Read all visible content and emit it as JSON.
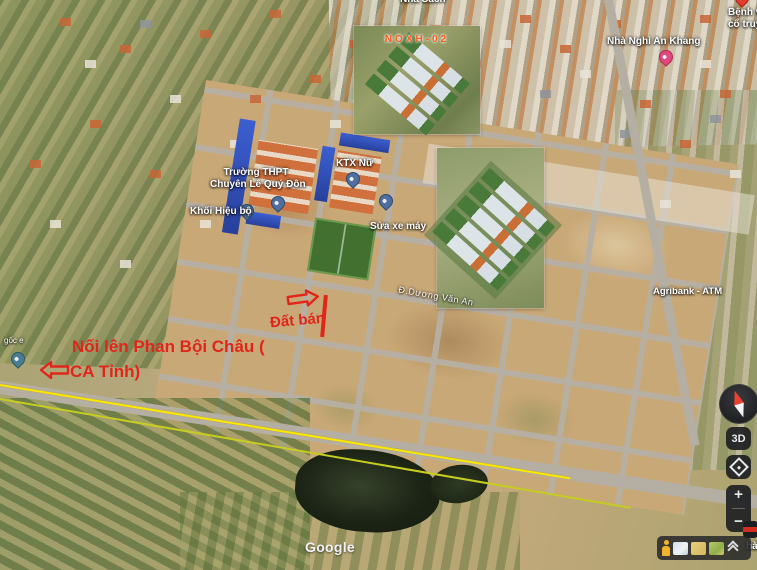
{
  "app_title": "satellite-map-view",
  "watermark": "Google",
  "red_annotations": {
    "color": "#e0251a",
    "dat_ban": "Đất bán",
    "route_note_line1": "Nối lên Phan Bội Châu (",
    "route_note_line2": "CA Tỉnh)"
  },
  "insets": {
    "small_render_title": "NOXH-02",
    "small_render_title_color": "#ff5a1e"
  },
  "poi_labels": {
    "school_line1": "Trường THPT",
    "school_line2": "Chuyên Lê Quý Đôn",
    "admin_block": "Khối Hiệu bộ",
    "female_dorm": "KTX Nữ",
    "bike_repair": "Sửa xe máy",
    "guesthouse": "Nhà Nghỉ An Khang",
    "hospital_partial_line1": "Bệnh vi",
    "hospital_partial_line2": "cổ truyề",
    "atm": "Agribank - ATM",
    "street_name": "Đ.Dương Văn An",
    "small_left_label": "gốc e",
    "top_edge_partial": "Nhà Sách",
    "right_edge_partial": "hà"
  },
  "route_highlight": {
    "upper_line_color": "#ffe600",
    "lower_line_color": "#c6cd22"
  },
  "controls": {
    "button_3d_label": "3D",
    "zoom_in_label": "+",
    "zoom_out_label": "−"
  },
  "icons": {
    "compass": "compass-icon",
    "street_view": "street-view-diamond-icon",
    "pegman": "pegman-icon",
    "expand": "chevron-up-icon",
    "map_pin": "map-pin-icon"
  }
}
